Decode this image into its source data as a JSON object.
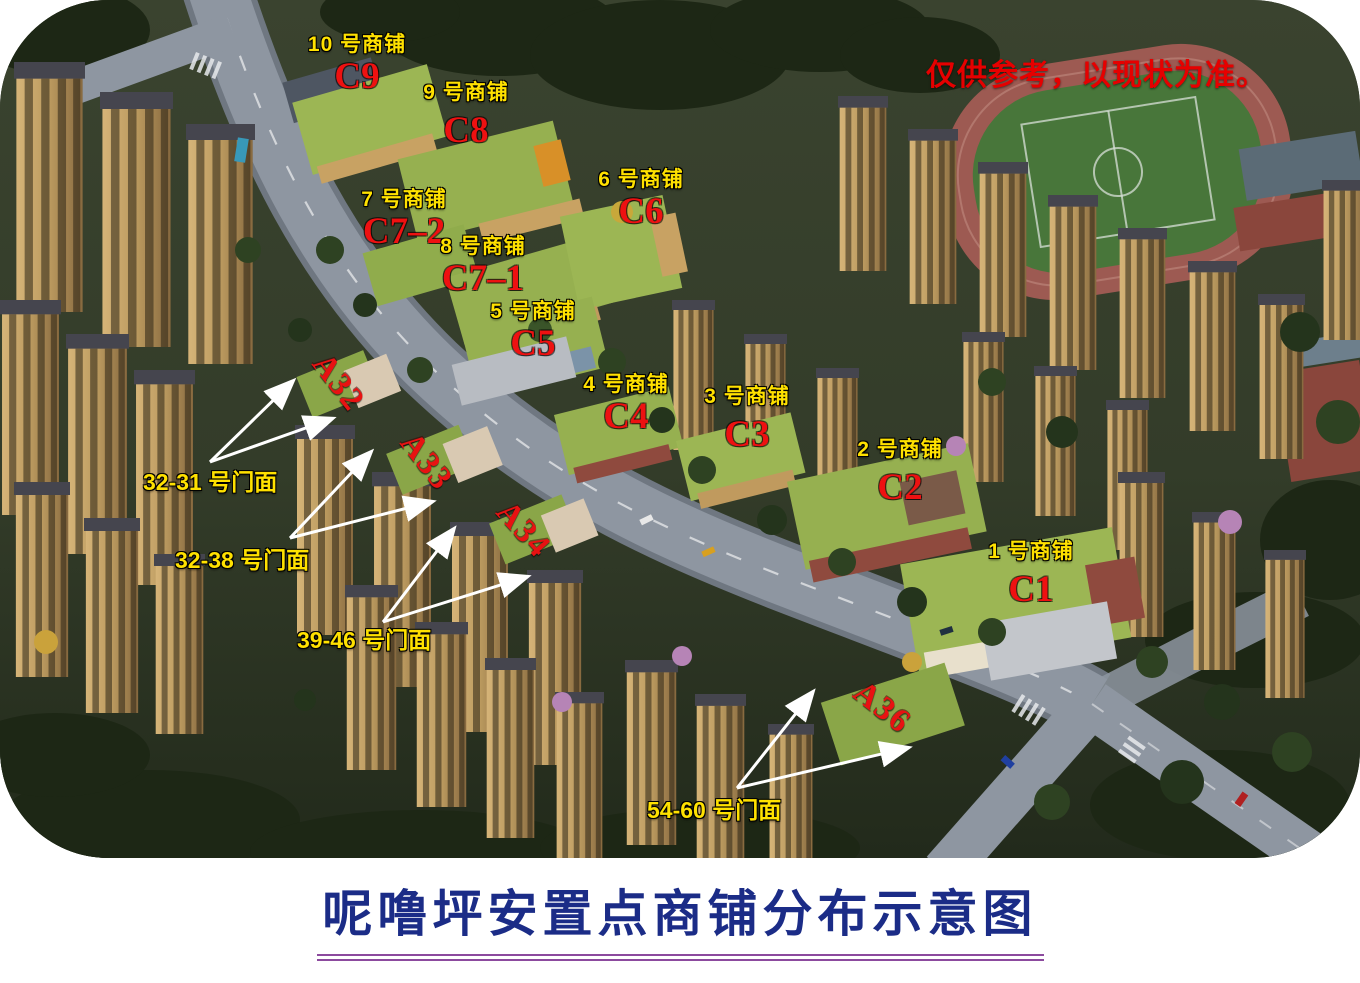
{
  "page": {
    "title": "呢噜坪安置点商铺分布示意图",
    "disclaimer": "仅供参考，以现状为准。"
  },
  "shops": [
    {
      "name": "1 号商铺",
      "code": "C1"
    },
    {
      "name": "2 号商铺",
      "code": "C2"
    },
    {
      "name": "3 号商铺",
      "code": "C3"
    },
    {
      "name": "4 号商铺",
      "code": "C4"
    },
    {
      "name": "5 号商铺",
      "code": "C5"
    },
    {
      "name": "6 号商铺",
      "code": "C6"
    },
    {
      "name": "7 号商铺",
      "code": "C7–2"
    },
    {
      "name": "8 号商铺",
      "code": "C7–1"
    },
    {
      "name": "9 号商铺",
      "code": "C8"
    },
    {
      "name": "10 号商铺",
      "code": "C9"
    }
  ],
  "blocks": [
    "A32",
    "A33",
    "A34",
    "A36"
  ],
  "storefronts": [
    "32-31 号门面",
    "32-38 号门面",
    "39-46 号门面",
    "54-60 号门面"
  ],
  "icons": {
    "annotation_arrow": "white-arrow"
  },
  "colors": {
    "shop_name_yellow": "#ffe100",
    "shop_code_red": "#ee1111",
    "block_code_red": "#e81212",
    "disclaimer_red": "#e60000",
    "title_navy": "#1b2c87",
    "title_underline_purple": "#8c4a9e",
    "arrow_white": "#ffffff",
    "shop_roof_green": "#96b050",
    "road_gray": "#8e96a1",
    "tower_tan": "#bb9a5f",
    "vegetation_dark_green": "#2f3826"
  }
}
